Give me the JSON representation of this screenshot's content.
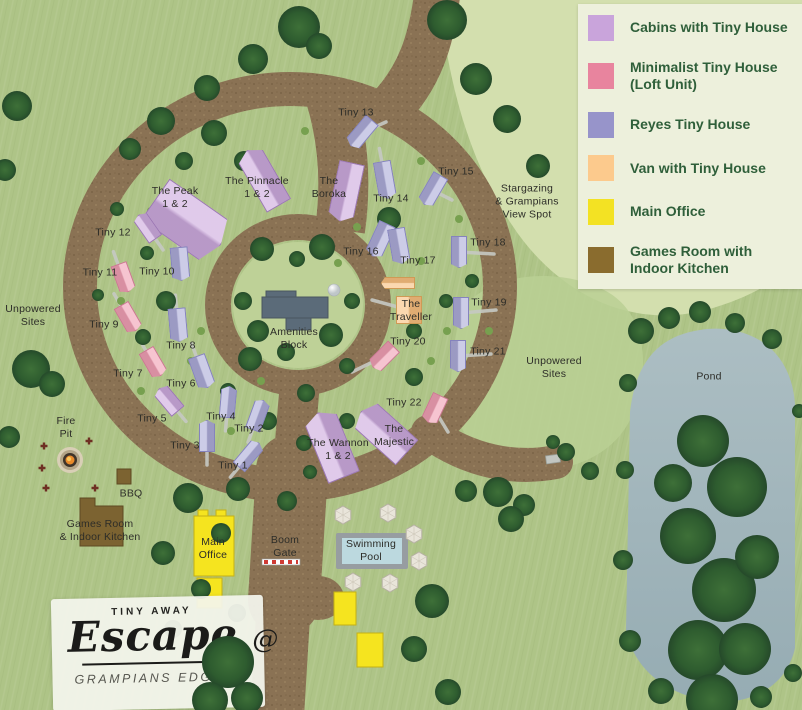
{
  "legend": {
    "items": [
      {
        "label": "Cabins with Tiny House",
        "color": "#c9a4db"
      },
      {
        "label": "Minimalist Tiny House (Loft Unit)",
        "color": "#e8849e"
      },
      {
        "label": "Reyes Tiny House",
        "color": "#9794ca"
      },
      {
        "label": "Van with Tiny House",
        "color": "#fcca8d"
      },
      {
        "label": "Main Office",
        "color": "#f3e223"
      },
      {
        "label": "Games Room with Indoor Kitchen",
        "color": "#8a6c2e"
      }
    ]
  },
  "map": {
    "area_labels": [
      {
        "id": "stargazing-spot",
        "text": "Stargazing\n& Grampians\nView Spot",
        "x": 527,
        "y": 202
      },
      {
        "id": "unpowered-sites-west",
        "text": "Unpowered\nSites",
        "x": 33,
        "y": 316
      },
      {
        "id": "unpowered-sites-east",
        "text": "Unpowered\nSites",
        "x": 554,
        "y": 368
      },
      {
        "id": "pond",
        "text": "Pond",
        "x": 709,
        "y": 377
      },
      {
        "id": "amenities-block",
        "text": "Amenities\nBlock",
        "x": 294,
        "y": 339
      },
      {
        "id": "fire-pit",
        "text": "Fire\nPit",
        "x": 66,
        "y": 428
      },
      {
        "id": "bbq",
        "text": "BBQ",
        "x": 131,
        "y": 494
      },
      {
        "id": "games-room",
        "text": "Games Room\n& Indoor Kitchen",
        "x": 100,
        "y": 531
      },
      {
        "id": "main-office",
        "text": "Main\nOffice",
        "x": 213,
        "y": 549
      },
      {
        "id": "boom-gate",
        "text": "Boom\nGate",
        "x": 285,
        "y": 547
      },
      {
        "id": "swimming-pool",
        "text": "Swimming\nPool",
        "x": 371,
        "y": 551
      }
    ],
    "sites": [
      {
        "id": "the-peak",
        "label": "The Peak\n1 & 2",
        "type": "cabin",
        "lx": 175,
        "ly": 198,
        "drive": false,
        "houses": [
          [
            188,
            222,
            50,
            80,
            125
          ]
        ]
      },
      {
        "id": "the-pinnacle",
        "label": "The Pinnacle\n1 & 2",
        "type": "cabin",
        "lx": 257,
        "ly": 188,
        "drive": false,
        "houses": [
          [
            263,
            178,
            28,
            64,
            -30
          ]
        ]
      },
      {
        "id": "the-boroka",
        "label": "The\nBoroka",
        "type": "cabin",
        "lx": 329,
        "ly": 188,
        "drive": false,
        "houses": [
          [
            346,
            192,
            26,
            60,
            -168
          ]
        ]
      },
      {
        "id": "tiny-13",
        "label": "Tiny 13",
        "type": "reyes",
        "lx": 356,
        "ly": 113,
        "drive": [
          386,
          122
        ],
        "houses": [
          [
            361,
            133,
            17,
            34,
            -140
          ]
        ]
      },
      {
        "id": "tiny-14",
        "label": "Tiny 14",
        "type": "reyes",
        "lx": 391,
        "ly": 199,
        "houses": [
          [
            385,
            180,
            18,
            38,
            170
          ]
        ]
      },
      {
        "id": "tiny-15",
        "label": "Tiny 15",
        "type": "reyes",
        "lx": 456,
        "ly": 172,
        "drive": [
          452,
          200
        ],
        "houses": [
          [
            432,
            190,
            17,
            34,
            -150
          ]
        ]
      },
      {
        "id": "tiny-16",
        "label": "Tiny 16",
        "type": "reyes",
        "lx": 361,
        "ly": 252,
        "houses": [
          [
            380,
            240,
            18,
            36,
            -155
          ]
        ]
      },
      {
        "id": "tiny-17",
        "label": "Tiny 17",
        "type": "reyes",
        "lx": 418,
        "ly": 261,
        "houses": [
          [
            399,
            246,
            18,
            36,
            170
          ]
        ]
      },
      {
        "id": "tiny-18",
        "label": "Tiny 18",
        "type": "reyes",
        "lx": 488,
        "ly": 243,
        "drive": [
          494,
          254
        ],
        "houses": [
          [
            459,
            252,
            16,
            32,
            180
          ]
        ]
      },
      {
        "id": "tiny-19",
        "label": "Tiny 19",
        "type": "reyes",
        "lx": 489,
        "ly": 303,
        "drive": [
          496,
          310
        ],
        "houses": [
          [
            461,
            313,
            16,
            32,
            180
          ]
        ]
      },
      {
        "id": "tiny-20",
        "label": "Tiny 20",
        "type": "mini",
        "lx": 408,
        "ly": 342,
        "drive": [
          352,
          372
        ],
        "houses": [
          [
            383,
            357,
            17,
            30,
            -135
          ]
        ]
      },
      {
        "id": "tiny-21",
        "label": "Tiny 21",
        "type": "reyes",
        "lx": 488,
        "ly": 352,
        "drive": [
          491,
          354
        ],
        "houses": [
          [
            458,
            356,
            16,
            32,
            180
          ]
        ]
      },
      {
        "id": "tiny-22",
        "label": "Tiny 22",
        "type": "mini",
        "lx": 404,
        "ly": 403,
        "drive": [
          448,
          432
        ],
        "houses": [
          [
            434,
            409,
            17,
            30,
            -155
          ]
        ]
      },
      {
        "id": "the-traveller",
        "label": "The\nTraveller",
        "type": "van",
        "lx": 411,
        "ly": 311,
        "drive": [
          372,
          300
        ],
        "houses": [
          [
            409,
            310,
            26,
            28,
            0,
            "sq"
          ],
          [
            398,
            283,
            12,
            34,
            -90
          ]
        ]
      },
      {
        "id": "the-wannon",
        "label": "The Wannon\n1 & 2",
        "type": "cabin",
        "lx": 338,
        "ly": 450,
        "drive": false,
        "houses": [
          [
            331,
            445,
            34,
            70,
            -22
          ]
        ]
      },
      {
        "id": "the-majestic",
        "label": "The\nMajestic",
        "type": "cabin",
        "lx": 394,
        "ly": 436,
        "drive": false,
        "houses": [
          [
            384,
            432,
            34,
            62,
            -48
          ]
        ]
      },
      {
        "id": "tiny-12",
        "label": "Tiny 12",
        "type": "cabin",
        "lx": 113,
        "ly": 233,
        "houses": [
          [
            147,
            227,
            16,
            30,
            -35
          ]
        ]
      },
      {
        "id": "tiny-11",
        "label": "Tiny 11",
        "type": "mini",
        "lx": 100,
        "ly": 273,
        "houses": [
          [
            123,
            278,
            17,
            30,
            160
          ]
        ]
      },
      {
        "id": "tiny-10",
        "label": "Tiny 10",
        "type": "reyes",
        "lx": 157,
        "ly": 272,
        "houses": [
          [
            180,
            264,
            18,
            34,
            175
          ]
        ]
      },
      {
        "id": "tiny-9",
        "label": "Tiny 9",
        "type": "mini",
        "lx": 104,
        "ly": 325,
        "houses": [
          [
            128,
            318,
            17,
            30,
            150
          ]
        ]
      },
      {
        "id": "tiny-8",
        "label": "Tiny 8",
        "type": "reyes",
        "lx": 181,
        "ly": 346,
        "houses": [
          [
            178,
            325,
            18,
            34,
            175
          ]
        ]
      },
      {
        "id": "tiny-7",
        "label": "Tiny 7",
        "type": "mini",
        "lx": 128,
        "ly": 374,
        "houses": [
          [
            153,
            363,
            17,
            30,
            150
          ]
        ]
      },
      {
        "id": "tiny-6",
        "label": "Tiny 6",
        "type": "reyes",
        "lx": 181,
        "ly": 384,
        "houses": [
          [
            202,
            372,
            18,
            34,
            160
          ]
        ]
      },
      {
        "id": "tiny-5",
        "label": "Tiny 5",
        "type": "cabin",
        "lx": 152,
        "ly": 419,
        "houses": [
          [
            168,
            400,
            17,
            30,
            -40
          ]
        ]
      },
      {
        "id": "tiny-4",
        "label": "Tiny 4",
        "type": "reyes",
        "lx": 221,
        "ly": 417,
        "houses": [
          [
            228,
            402,
            16,
            32,
            5
          ]
        ]
      },
      {
        "id": "tiny-3",
        "label": "Tiny 3",
        "type": "reyes",
        "lx": 185,
        "ly": 446,
        "houses": [
          [
            207,
            436,
            16,
            32,
            0
          ]
        ]
      },
      {
        "id": "tiny-2",
        "label": "Tiny 2",
        "type": "reyes",
        "lx": 249,
        "ly": 429,
        "houses": [
          [
            258,
            415,
            16,
            32,
            20
          ]
        ]
      },
      {
        "id": "tiny-1",
        "label": "Tiny 1",
        "type": "reyes",
        "lx": 233,
        "ly": 466,
        "houses": [
          [
            249,
            455,
            16,
            32,
            40
          ]
        ]
      }
    ]
  },
  "logo": {
    "brand_top": "TINY AWAY",
    "brand_main": "Escape",
    "brand_at": "@",
    "brand_sub": "GRAMPIANS EDGE"
  }
}
